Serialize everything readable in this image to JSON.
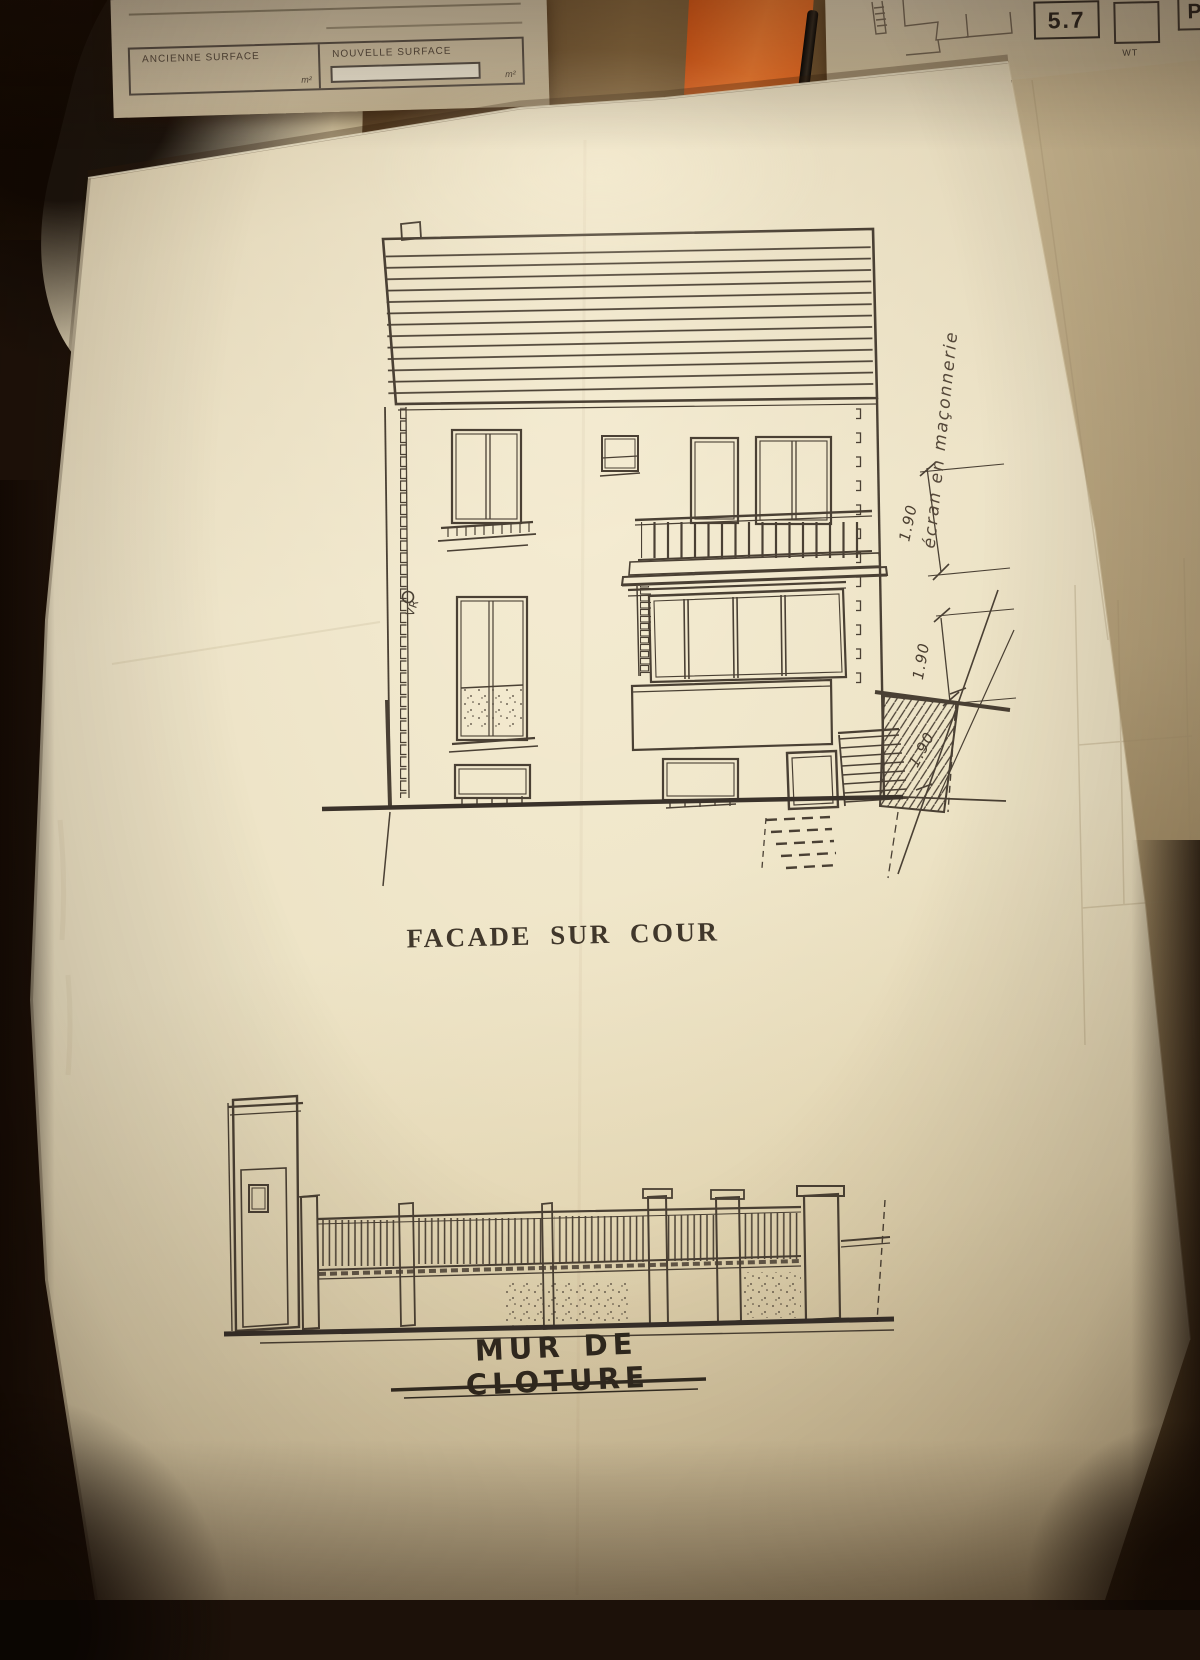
{
  "photo": {
    "form_table": {
      "col1_label": "ANCIENNE SURFACE",
      "col1_unit": "m²",
      "col2_label": "NOUVELLE SURFACE",
      "col2_unit": "m²"
    },
    "top_right_paper": {
      "box_value": "5.7",
      "box2_label": "WT",
      "box3_label": "P"
    },
    "colors": {
      "folder_orange": "#e2661f",
      "paper_cream": "#ece2c4",
      "ink": "#4a4034"
    }
  },
  "facade": {
    "caption": "FACADE SUR COUR",
    "annotations": {
      "masonry_note": "écran en maçonnerie",
      "vent_label": "VR",
      "dim_upper": "1.90",
      "dim_mid": "1.90",
      "dim_wall": "1.90"
    }
  },
  "fence": {
    "caption": "MUR DE CLOTURE"
  }
}
